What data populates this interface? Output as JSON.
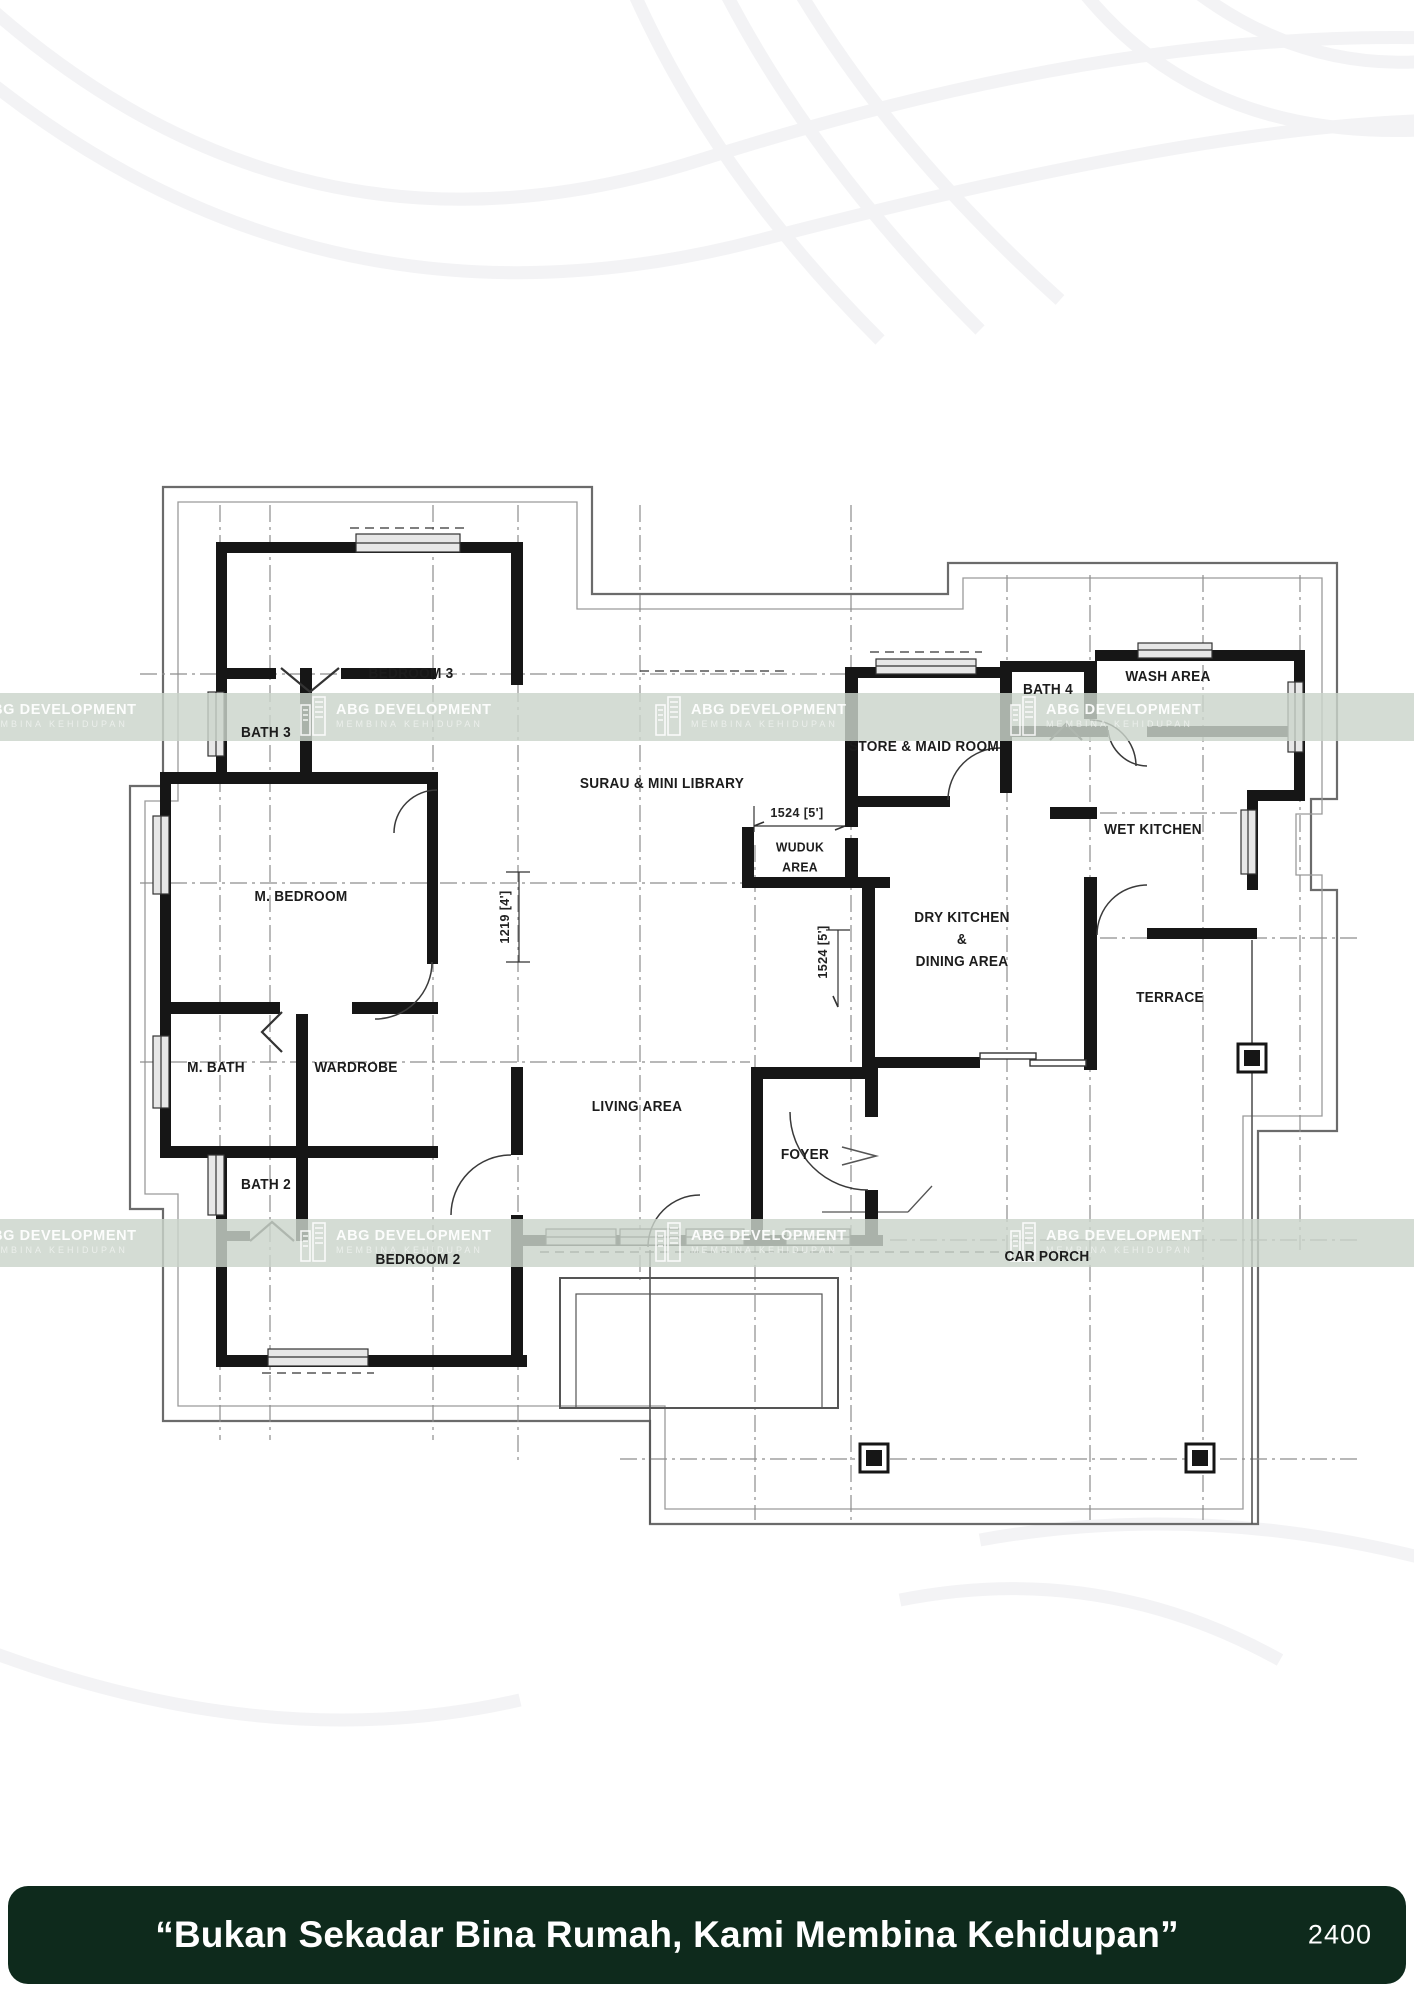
{
  "plan": {
    "labels": {
      "bedroom3": "BEDROOM 3",
      "bath3": "BATH 3",
      "surau": "SURAU & MINI LIBRARY",
      "wuduk1": "WUDUK",
      "wuduk2": "AREA",
      "store": "STORE & MAID ROOM",
      "bath4": "BATH 4",
      "wash": "WASH AREA",
      "wet": "WET KITCHEN",
      "dry1": "DRY KITCHEN",
      "dry2": "&",
      "dry3": "DINING AREA",
      "terrace": "TERRACE",
      "mbedroom": "M. BEDROOM",
      "mbath": "M. BATH",
      "wardrobe": "WARDROBE",
      "bath2": "BATH 2",
      "bedroom2": "BEDROOM 2",
      "living": "LIVING AREA",
      "foyer": "FOYER",
      "carporch": "CAR PORCH",
      "dim_wuduk": "1524  [5']",
      "dim_foyer": "1524  [5']",
      "dim_hall": "1219  [4']"
    }
  },
  "watermark": {
    "brand": "ABG DEVELOPMENT",
    "tagline": "MEMBINA KEHIDUPAN"
  },
  "footer": {
    "slogan": "“Bukan Sekadar Bina Rumah, Kami Membina Kehidupan”",
    "code": "2400",
    "bg_color": "#0e2a1c"
  }
}
